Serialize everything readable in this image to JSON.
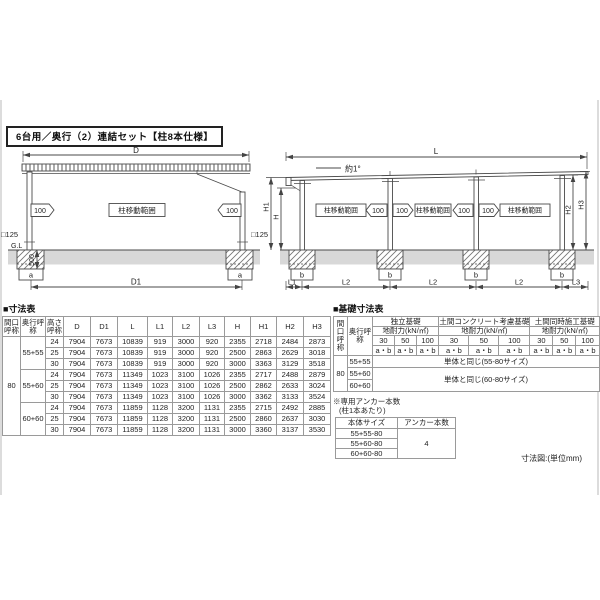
{
  "title": "6台用／奥行（2）連結セット【柱8本仕様】",
  "labels": {
    "d": "D",
    "d1": "D1",
    "l": "L",
    "l1": "L1",
    "l2": "L2",
    "l3": "L3",
    "h": "H",
    "h1": "H1",
    "h2": "H2",
    "h3": "H3",
    "move": "100",
    "range": "柱移動範囲",
    "post_size": "□125",
    "gl": "G.L",
    "footing_depth": "500",
    "a": "a",
    "b": "b",
    "slope": "約1°"
  },
  "dim_table": {
    "heading": "■寸法表",
    "headers": [
      "間口呼称",
      "奥行呼称",
      "高さ呼称",
      "D",
      "D1",
      "L",
      "L1",
      "L2",
      "L3",
      "H",
      "H1",
      "H2",
      "H3"
    ],
    "maguchi": "80",
    "depths": [
      "55+55",
      "55+60",
      "60+60"
    ],
    "rows": [
      [
        "24",
        "7904",
        "7673",
        "10839",
        "919",
        "3000",
        "920",
        "2355",
        "2718",
        "2484",
        "2873"
      ],
      [
        "25",
        "7904",
        "7673",
        "10839",
        "919",
        "3000",
        "920",
        "2500",
        "2863",
        "2629",
        "3018"
      ],
      [
        "30",
        "7904",
        "7673",
        "10839",
        "919",
        "3000",
        "920",
        "3000",
        "3363",
        "3129",
        "3518"
      ],
      [
        "24",
        "7904",
        "7673",
        "11349",
        "1023",
        "3100",
        "1026",
        "2355",
        "2717",
        "2488",
        "2879"
      ],
      [
        "25",
        "7904",
        "7673",
        "11349",
        "1023",
        "3100",
        "1026",
        "2500",
        "2862",
        "2633",
        "3024"
      ],
      [
        "30",
        "7904",
        "7673",
        "11349",
        "1023",
        "3100",
        "1026",
        "3000",
        "3362",
        "3133",
        "3524"
      ],
      [
        "24",
        "7904",
        "7673",
        "11859",
        "1128",
        "3200",
        "1131",
        "2355",
        "2715",
        "2492",
        "2885"
      ],
      [
        "25",
        "7904",
        "7673",
        "11859",
        "1128",
        "3200",
        "1131",
        "2500",
        "2860",
        "2637",
        "3030"
      ],
      [
        "30",
        "7904",
        "7673",
        "11859",
        "1128",
        "3200",
        "1131",
        "3000",
        "3360",
        "3137",
        "3530"
      ]
    ]
  },
  "found_table": {
    "heading": "■基礎寸法表",
    "maguchi_h": "間口呼称",
    "okuyuki_h": "奥行呼称",
    "groups": [
      "独立基礎",
      "土間コンクリート考慮基礎",
      "土間同時施工基礎"
    ],
    "load_label": "地耐力(kN/㎡)",
    "loads": [
      "30",
      "50",
      "100"
    ],
    "ab": "a・b",
    "maguchi": "80",
    "depths": [
      "55+55",
      "55+60",
      "60+60"
    ],
    "same_5580": "単体と同じ(55-80サイズ)",
    "same_6080": "単体と同じ(60-80サイズ)"
  },
  "anchor": {
    "note1": "※専用アンカー本数",
    "note2": "(柱1本あたり)",
    "size_h": "本体サイズ",
    "count_h": "アンカー本数",
    "sizes": [
      "55+55-80",
      "55+60-80",
      "60+60-80"
    ],
    "count": "4"
  },
  "footer_note": "寸法図:(単位mm)"
}
